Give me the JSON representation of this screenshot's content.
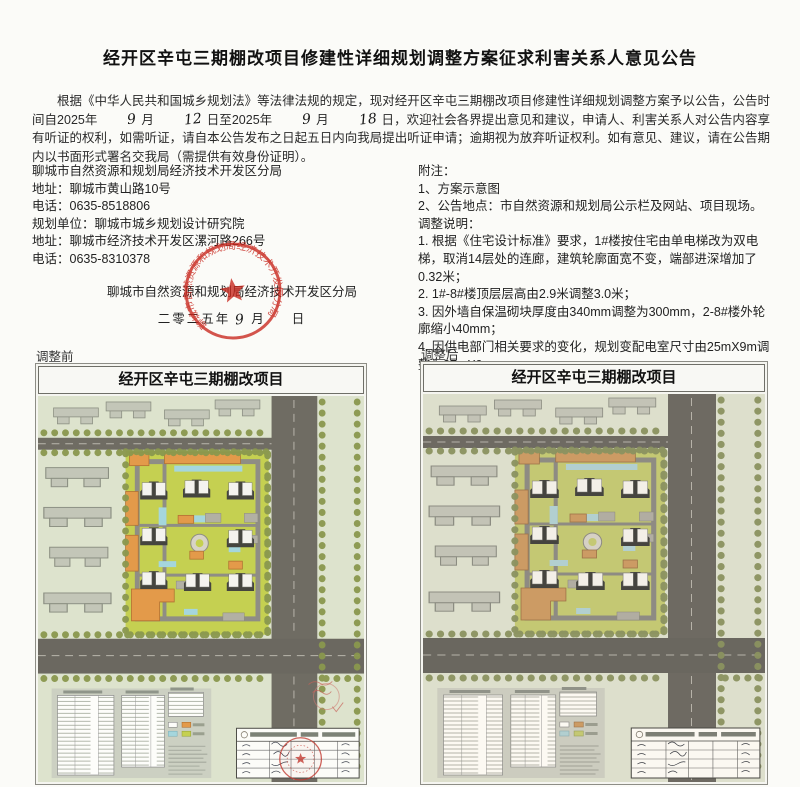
{
  "page": {
    "title": "经开区辛屯三期棚改项目修建性详细规划调整方案征求利害关系人意见公告"
  },
  "body": {
    "p1_pre": "根据《中华人民共和国城乡规划法》等法律法规的规定，现对经开区辛屯三期棚改项目修建性详细规划调整方案予以公告，公告时间自2025年",
    "hw_month1": "9",
    "p1_mid1": "月",
    "hw_day1": "12",
    "p1_mid2": "日至2025年",
    "hw_month2": "9",
    "p1_mid3": "月",
    "hw_day2": "18",
    "p1_post": "日，欢迎社会各界提出意见和建议，申请人、利害关系人对公告内容享有听证的权利，如需听证，请自本公告发布之日起五日内向我局提出听证申请；逾期视为放弃听证权利。如有意见、建议，请在公告期内以书面形式署名交我局（需提供有效身份证明）。"
  },
  "contact": {
    "bureau": "聊城市自然资源和规划局经济技术开发区分局",
    "address1": "地址：聊城市黄山路10号",
    "phone1": "电话：0635-8518806",
    "planner": "规划单位：聊城市城乡规划设计研究院",
    "address2": "地址：聊城市经济技术开发区漯河路266号",
    "phone2": "电话：0635-8310378"
  },
  "notes": {
    "heading": "附注：",
    "item1": "1、方案示意图",
    "item2": "2、公告地点：市自然资源和规划局公示栏及网站、项目现场。",
    "adjust_heading": "调整说明：",
    "adjust1": "1. 根据《住宅设计标准》要求，1#楼按住宅由单电梯改为双电梯，取消14层处的连廊，建筑轮廓面宽不变，端部进深增加了0.32米；",
    "adjust2": "2. 1#-8#楼顶层层高由2.9米调整3.0米；",
    "adjust3": "3. 因外墙自保温砌块厚度由340mm调整为300mm，2-8#楼外轮廓缩小40mm；",
    "adjust4": "4. 因供电部门相关要求的变化，规划变配电室尺寸由25mX9m调整为27mX9m"
  },
  "signature": {
    "org": "聊城市自然资源和规划局经济技术开发区分局",
    "date_year": "二零二五年",
    "date_month_hw": "9",
    "date_month_char": "月",
    "date_day_char": "日",
    "stamp_text": "聊城市自然资源和规划局经济技术开发区分局"
  },
  "plans": {
    "before_label": "调整前",
    "after_label": "调整后",
    "plan_title": "经开区辛屯三期棚改项目"
  },
  "colors": {
    "stamp_red": "#c8281e",
    "road_gray": "#6f6c63",
    "compound_green": "#c5d051",
    "block_green": "#dde3cd",
    "tree_olive": "#8a984e",
    "building_orange": "#e39a4a",
    "water_blue": "#a5d6dd"
  }
}
